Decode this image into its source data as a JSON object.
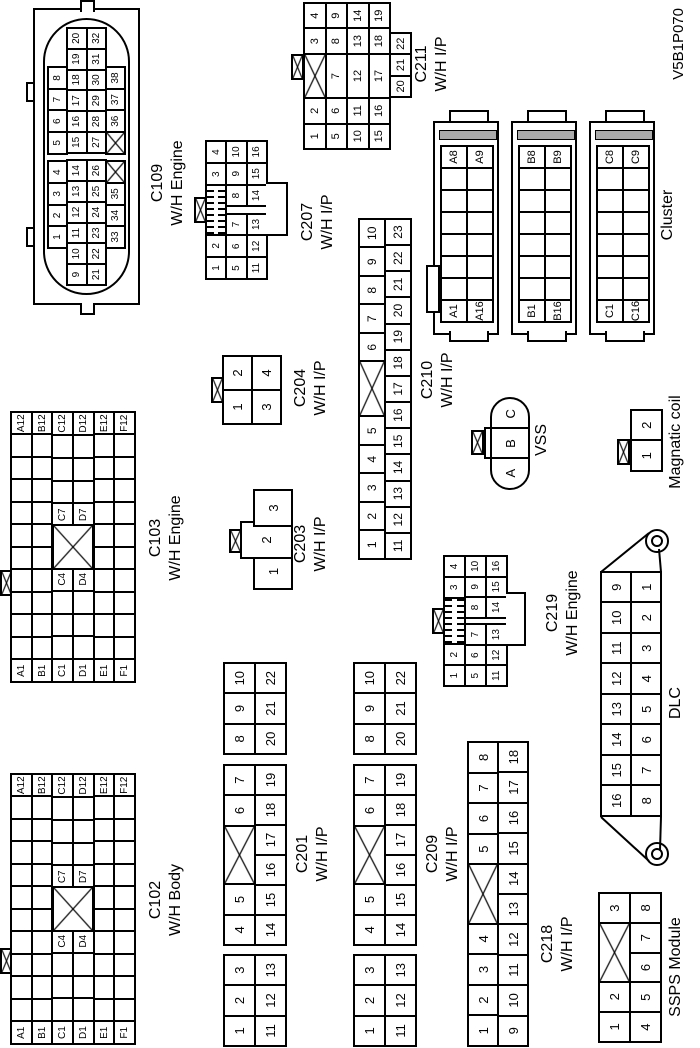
{
  "figure_code": "V5B1P070",
  "labels": {
    "cluster": "Cluster",
    "vss": "VSS",
    "dlc": "DLC",
    "ssps": "SSPS Module",
    "magcoil": "Magnatic coil"
  },
  "connectors": {
    "c109": {
      "name": "C109",
      "sub": "W/H Engine",
      "rows": [
        [
          {
            "g": 2
          },
          "1",
          "2",
          "3",
          "4",
          {
            "g": 0.4
          },
          "5",
          "6",
          "7",
          "8",
          {
            "g": 2
          }
        ],
        [
          "9",
          "10",
          "11",
          "12",
          "13",
          "14",
          {
            "g": 0.4
          },
          "15",
          "16",
          "17",
          "18",
          "19",
          "20"
        ],
        [
          "21",
          "22",
          "23",
          "24",
          "25",
          "26",
          {
            "g": 0.4
          },
          "27",
          "28",
          "29",
          "30",
          "31",
          "32"
        ],
        [
          {
            "g": 2
          },
          "33",
          "34",
          "35",
          {
            "x": 1
          },
          {
            "g": 0.4
          },
          {
            "x": 1
          },
          "36",
          "37",
          "38",
          {
            "g": 2
          }
        ]
      ]
    },
    "c207": {
      "name": "C207",
      "sub": "W/H I/P",
      "rows": [
        [
          "1",
          "2",
          {
            "lock": 2.36
          },
          "3",
          "4"
        ],
        [
          "5",
          "6",
          "7",
          {
            "g": 0.36
          },
          "8",
          "9",
          "10"
        ],
        [
          "11",
          "12",
          "13",
          {
            "g": 0.36
          },
          "14",
          "15",
          "16"
        ]
      ]
    },
    "c211": {
      "name": "C211",
      "sub": "W/H I/P",
      "rows": [
        [
          "1",
          "2",
          {
            "x": 1.8
          },
          "3",
          "4"
        ],
        [
          "5",
          "6",
          {
            "t": "7",
            "w": 1.8
          },
          "8",
          "9"
        ],
        [
          "10",
          "11",
          {
            "t": "12",
            "w": 1.8
          },
          "13",
          "14"
        ],
        [
          "15",
          "16",
          {
            "t": "17",
            "w": 1.8
          },
          "18",
          "19"
        ]
      ],
      "ext": [
        [
          "20",
          "21",
          "22"
        ]
      ]
    },
    "cluster_a": {
      "rows": [
        [
          "A1",
          "",
          "",
          "",
          "",
          "",
          "",
          "A8"
        ],
        [
          "A16",
          "",
          "",
          "",
          "",
          "",
          "",
          "A9"
        ]
      ]
    },
    "cluster_b": {
      "rows": [
        [
          "B1",
          "",
          "",
          "",
          "",
          "",
          "",
          "B8"
        ],
        [
          "B16",
          "",
          "",
          "",
          "",
          "",
          "",
          "B9"
        ]
      ]
    },
    "cluster_c": {
      "rows": [
        [
          "C1",
          "",
          "",
          "",
          "",
          "",
          "",
          "C8"
        ],
        [
          "C16",
          "",
          "",
          "",
          "",
          "",
          "",
          "C9"
        ]
      ]
    },
    "c103": {
      "name": "C103",
      "sub": "W/H Engine",
      "rows": [
        [
          "A1",
          "",
          "",
          "",
          "",
          "",
          "",
          "",
          "",
          "",
          "",
          "A12"
        ],
        [
          "B1",
          "",
          "",
          "",
          "",
          "",
          "",
          "",
          "",
          "",
          "",
          "B12"
        ],
        [
          "C1",
          "",
          "",
          "",
          "C4",
          {
            "g": 2
          },
          "C7",
          "",
          "",
          "",
          "C12"
        ],
        [
          "D1",
          "",
          "",
          "",
          "D4",
          {
            "g": 2
          },
          "D7",
          "",
          "",
          "",
          "D12"
        ],
        [
          "E1",
          "",
          "",
          "",
          "",
          "",
          "",
          "",
          "",
          "",
          "",
          "E12"
        ],
        [
          "F1",
          "",
          "",
          "",
          "",
          "",
          "",
          "",
          "",
          "",
          "",
          "F12"
        ]
      ]
    },
    "c102": {
      "name": "C102",
      "sub": "W/H Body",
      "rows": [
        [
          "A1",
          "",
          "",
          "",
          "",
          "",
          "",
          "",
          "",
          "",
          "",
          "A12"
        ],
        [
          "B1",
          "",
          "",
          "",
          "",
          "",
          "",
          "",
          "",
          "",
          "",
          "B12"
        ],
        [
          "C1",
          "",
          "",
          "",
          "C4",
          {
            "g": 2
          },
          "C7",
          "",
          "",
          "",
          "C12"
        ],
        [
          "D1",
          "",
          "",
          "",
          "D4",
          {
            "g": 2
          },
          "D7",
          "",
          "",
          "",
          "D12"
        ],
        [
          "E1",
          "",
          "",
          "",
          "",
          "",
          "",
          "",
          "",
          "",
          "",
          "E12"
        ],
        [
          "F1",
          "",
          "",
          "",
          "",
          "",
          "",
          "",
          "",
          "",
          "",
          "F12"
        ]
      ]
    },
    "c201": {
      "name": "C201",
      "sub": "W/H I/P",
      "g1": [
        [
          "1",
          "2",
          "3"
        ],
        [
          "11",
          "12",
          "13"
        ]
      ],
      "g2": [
        [
          "4",
          "5",
          {
            "x": 2
          },
          "6",
          "7"
        ],
        [
          "14",
          "15",
          "16",
          "17",
          "18",
          "19"
        ]
      ],
      "g3": [
        [
          "8",
          "9",
          "10"
        ],
        [
          "20",
          "21",
          "22"
        ]
      ]
    },
    "c209": {
      "name": "C209",
      "sub": "W/H I/P",
      "g1": [
        [
          "1",
          "2",
          "3"
        ],
        [
          "11",
          "12",
          "13"
        ]
      ],
      "g2": [
        [
          "4",
          "5",
          {
            "x": 2
          },
          "6",
          "7"
        ],
        [
          "14",
          "15",
          "16",
          "17",
          "18",
          "19"
        ]
      ],
      "g3": [
        [
          "8",
          "9",
          "10"
        ],
        [
          "20",
          "21",
          "22"
        ]
      ]
    },
    "c218": {
      "name": "C218",
      "sub": "W/H I/P",
      "rows": [
        [
          "1",
          "2",
          "3",
          "4",
          {
            "x": 2
          },
          "5",
          "6",
          "7",
          "8"
        ],
        [
          "9",
          "10",
          "11",
          "12",
          "13",
          "14",
          "15",
          "16",
          "17",
          "18"
        ]
      ]
    },
    "c219": {
      "name": "C219",
      "sub": "W/H Engine",
      "rows": [
        [
          "1",
          "2",
          {
            "lock": 2.36
          },
          "3",
          "4"
        ],
        [
          "5",
          "6",
          "7",
          {
            "g": 0.36
          },
          "8",
          "9",
          "10"
        ],
        [
          "11",
          "12",
          "13",
          {
            "g": 0.36
          },
          "14",
          "15",
          "16"
        ]
      ]
    },
    "c210": {
      "name": "C210",
      "sub": "W/H I/P",
      "rows": [
        [
          "1",
          "2",
          "3",
          "4",
          "5",
          {
            "x": 2
          },
          "6",
          "7",
          "8",
          "9",
          "10"
        ],
        [
          "11",
          "12",
          "13",
          "14",
          "15",
          "16",
          "17",
          "18",
          "19",
          "20",
          "21",
          "22",
          "23"
        ]
      ]
    },
    "c204": {
      "name": "C204",
      "sub": "W/H I/P",
      "rows": [
        [
          "1",
          "2"
        ],
        [
          "3",
          "4"
        ]
      ]
    },
    "c203": {
      "name": "C203",
      "sub": "W/H I/P",
      "pins": [
        "1",
        "2",
        "3"
      ]
    },
    "vss": {
      "pins": [
        "A",
        "B",
        "C"
      ]
    },
    "magcoil": {
      "rows": [
        [
          "1",
          "2"
        ]
      ]
    },
    "dlc": {
      "rows": [
        [
          "16",
          "15",
          "14",
          "13",
          "12",
          "11",
          "10",
          "9"
        ],
        [
          "8",
          "7",
          "6",
          "5",
          "4",
          "3",
          "2",
          "1"
        ]
      ]
    },
    "ssps": {
      "rows": [
        [
          "1",
          "2",
          {
            "x": 2
          },
          "3"
        ],
        [
          "4",
          "5",
          "6",
          "7",
          "8"
        ]
      ]
    }
  }
}
